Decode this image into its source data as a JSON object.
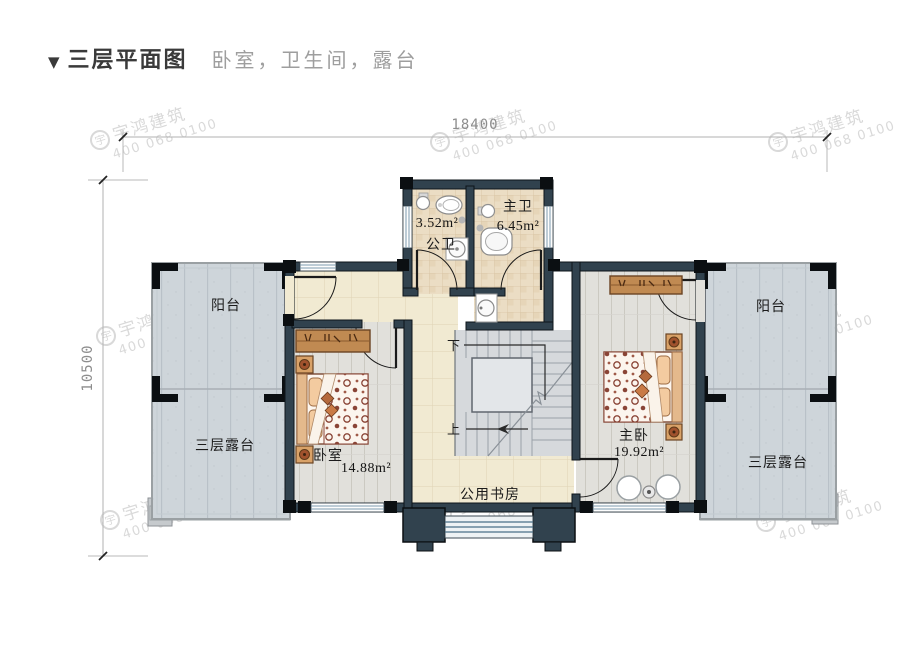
{
  "header": {
    "marker": "▼",
    "title": "三层平面图",
    "subtitle": "卧室，卫生间，露台"
  },
  "dimensions": {
    "width_label": "18400",
    "height_label": "10500"
  },
  "watermark": {
    "logo_char": "宇",
    "brand": "宇鸿建筑",
    "phone": "400 068 0100"
  },
  "rooms": {
    "balcony_left": {
      "label": "阳台"
    },
    "balcony_right": {
      "label": "阳台"
    },
    "terrace_left": {
      "label": "三层露台"
    },
    "terrace_right": {
      "label": "三层露台"
    },
    "bedroom": {
      "label": "卧室",
      "area": "14.88m²"
    },
    "master_bedroom": {
      "label": "主卧",
      "area": "19.92m²"
    },
    "public_bath": {
      "label": "公卫",
      "area": "3.52m²"
    },
    "master_bath": {
      "label": "主卫",
      "area": "6.45m²"
    },
    "study": {
      "label": "公用书房"
    },
    "stairs": {
      "up_label": "上",
      "down_label": "下"
    }
  },
  "colors": {
    "wall": "#31424e",
    "wall_edge": "#0d1419",
    "floor_wood": "#e1e0db",
    "floor_balcony": "#ced5da",
    "floor_tile": "#f1ead2",
    "floor_bath": "#ebddc4",
    "watermark": "#d9d9d9",
    "furniture_wood": "#c08a52"
  }
}
